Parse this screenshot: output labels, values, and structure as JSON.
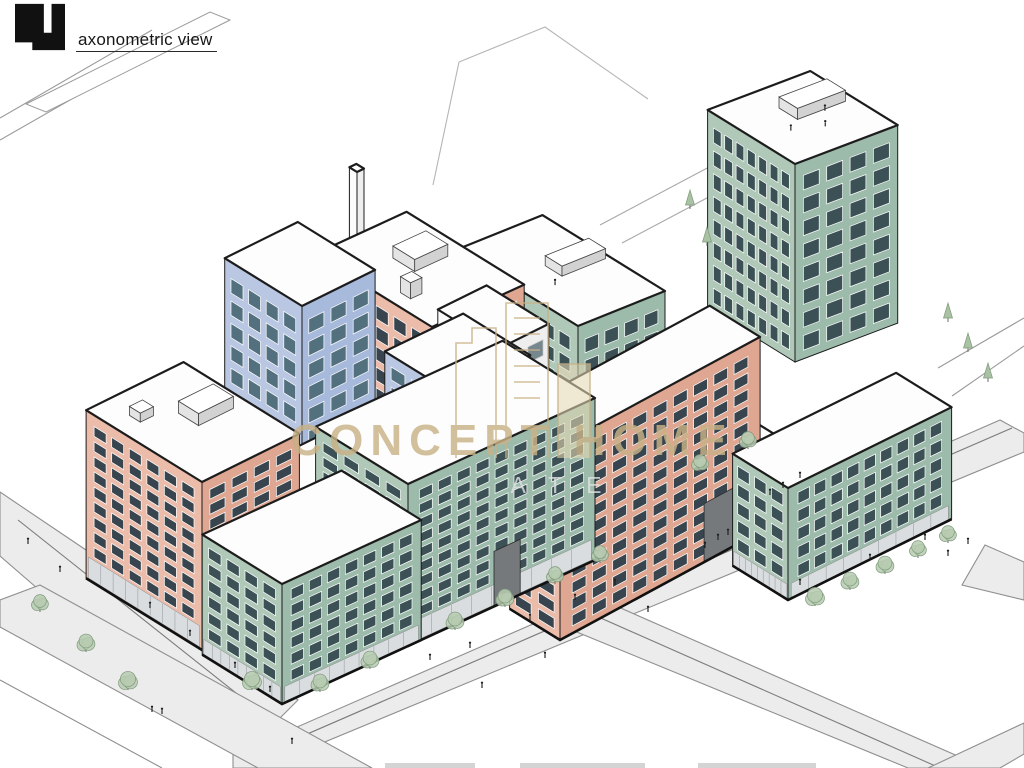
{
  "header": {
    "title": "axonometric view",
    "logo": "blocky-numeral-4-logo"
  },
  "watermark": {
    "title": "CONCEPT HOME",
    "visible_fragment": "ATE",
    "icon": "towers-outline-icon",
    "color": "#c9b287"
  },
  "footer": {
    "cropped_fragments": 3
  },
  "palette": {
    "salmon": {
      "sw": "#ecbcab",
      "se": "#dfa691",
      "glass": "#39454e",
      "frame": "#ffffff"
    },
    "green": {
      "sw": "#afc8b8",
      "se": "#9dbbab",
      "glass": "#3c5156",
      "frame": "#ffffff"
    },
    "blue": {
      "sw": "#b9c7e3",
      "se": "#a8badb",
      "glass": "#53707f",
      "frame": "#ffffff"
    },
    "white": {
      "sw": "#fbfbfb",
      "se": "#eeeeee",
      "glass": "#76878e",
      "frame": "#c9c9c9"
    },
    "roof": "#fdfdfd",
    "outline": "#1c1c1c",
    "road_fill": "#ececec",
    "road_edge": "#8f8f8f",
    "store": "#d9dde0",
    "arch": "#75797c",
    "tree_fill": "#b7cbb2",
    "tree_stroke": "#7e9a7a",
    "person": "#1f1f1f"
  },
  "scene": {
    "buildings": [
      {
        "name": "chimney",
        "color": "white",
        "f": [
          357,
          290
        ],
        "wR": 8,
        "wL": 9,
        "h": 118,
        "floors": 0,
        "colsSE": 0,
        "colsSW": 0
      },
      {
        "name": "tower-north-east",
        "color": "green",
        "f": [
          795,
          362
        ],
        "wR": 118,
        "wL": 104,
        "h": 198,
        "floors": 8,
        "colsSE": 4,
        "colsSW": 7,
        "ux": 0.87,
        "uy": -0.33,
        "roofBoxes": [
          {
            "fu": 0.45,
            "fv": 0.5,
            "su": 55,
            "sl": 22,
            "h": 11
          }
        ],
        "roofPeople": 3
      },
      {
        "name": "tower-north",
        "color": "green",
        "f": [
          578,
          558
        ],
        "wR": 100,
        "wL": 146,
        "h": 232,
        "floors": 10,
        "colsSE": 4,
        "colsSW": 7,
        "ux": 0.87,
        "uy": -0.35,
        "roofBoxes": [
          {
            "fu": 0.45,
            "fv": 0.45,
            "su": 50,
            "sl": 20,
            "h": 10
          }
        ],
        "roofPeople": 1
      },
      {
        "name": "midrise-back-salmon",
        "color": "salmon",
        "f": [
          432,
          505
        ],
        "wR": 106,
        "wL": 140,
        "h": 178,
        "floors": 8,
        "colsSE": 4,
        "colsSW": 6,
        "ux": 0.87,
        "uy": -0.4,
        "roofBoxes": [
          {
            "fu": 0.45,
            "fv": 0.5,
            "su": 38,
            "sl": 26,
            "h": 12
          },
          {
            "fu": 0.15,
            "fv": 0.3,
            "su": 13,
            "sl": 12,
            "h": 16
          }
        ]
      },
      {
        "name": "tower-back-blue",
        "color": "blue",
        "f": [
          302,
          548
        ],
        "wR": 84,
        "wL": 92,
        "h": 242,
        "floors": 10,
        "colsSE": 3,
        "colsSW": 4
      },
      {
        "name": "courtyard-building-white",
        "color": "white",
        "f": [
          500,
          508
        ],
        "wR": 56,
        "wL": 74,
        "h": 160,
        "floors": 6,
        "colsSE": 2,
        "colsSW": 3
      },
      {
        "name": "courtyard-roof-east",
        "color": "white",
        "f": [
          705,
          512
        ],
        "wR": 100,
        "wL": 118,
        "h": 24,
        "floors": 0,
        "roofPeople": 5
      },
      {
        "name": "block-center-salmon",
        "color": "salmon",
        "f": [
          560,
          640
        ],
        "wR": 230,
        "wL": 60,
        "h": 195,
        "floors": 11,
        "colsSE": 9,
        "colsSW": 2,
        "ux": 0.87,
        "uy": -0.47,
        "base": true,
        "arch": {
          "face": "SE",
          "u0": 0.72,
          "u1": 0.88,
          "v0": 0.7
        }
      },
      {
        "name": "podium-east-green",
        "color": "green",
        "f": [
          788,
          600
        ],
        "wR": 188,
        "wL": 66,
        "h": 112,
        "floors": 5,
        "colsSE": 9,
        "colsSW": 3,
        "store": true,
        "base": true
      },
      {
        "name": "courtyard-roof-west",
        "color": "white",
        "f": [
          352,
          596
        ],
        "wR": 140,
        "wL": 150,
        "h": 36,
        "floors": 0,
        "roofPeople": 6
      },
      {
        "name": "tower-west-salmon",
        "color": "salmon",
        "f": [
          202,
          650
        ],
        "wR": 112,
        "wL": 138,
        "h": 168,
        "floors": 9,
        "colsSE": 4,
        "colsSW": 6,
        "store": true,
        "base": true,
        "roofBoxes": [
          {
            "fu": 0.5,
            "fv": 0.45,
            "su": 40,
            "sl": 24,
            "h": 12
          },
          {
            "fu": 0.2,
            "fv": 0.7,
            "su": 15,
            "sl": 13,
            "h": 9
          }
        ]
      },
      {
        "name": "tower-front-blue",
        "color": "blue",
        "f": [
          452,
          545
        ],
        "wR": 90,
        "wL": 80,
        "h": 152,
        "floors": 7,
        "colsSE": 4,
        "colsSW": 3,
        "ux": 0.87,
        "uy": -0.42
      },
      {
        "name": "podium-front-green",
        "color": "green",
        "f": [
          408,
          646
        ],
        "wR": 215,
        "wL": 110,
        "h": 162,
        "floors": 9,
        "colsSE": 9,
        "colsSW": 4,
        "ux": 0.87,
        "uy": -0.4,
        "store": true,
        "base": true,
        "arch": {
          "face": "SE",
          "u0": 0.46,
          "u1": 0.6,
          "v0": 0.66
        }
      },
      {
        "name": "corner-front-green",
        "color": "green",
        "f": [
          282,
          704
        ],
        "wR": 160,
        "wL": 95,
        "h": 120,
        "floors": 6,
        "colsSE": 7,
        "colsSW": 4,
        "ux": 0.87,
        "uy": -0.4,
        "store": true,
        "base": true
      }
    ],
    "trees": {
      "leafy": [
        [
          40,
          612,
          7
        ],
        [
          86,
          652,
          8
        ],
        [
          128,
          690,
          9
        ],
        [
          252,
          690,
          9
        ],
        [
          320,
          692,
          8
        ],
        [
          370,
          669,
          8
        ],
        [
          455,
          630,
          8
        ],
        [
          505,
          607,
          8
        ],
        [
          555,
          584,
          7
        ],
        [
          600,
          563,
          7
        ],
        [
          815,
          606,
          9
        ],
        [
          850,
          590,
          8
        ],
        [
          885,
          574,
          8
        ],
        [
          918,
          558,
          7
        ],
        [
          948,
          543,
          7
        ],
        [
          700,
          472,
          7
        ],
        [
          748,
          449,
          7
        ]
      ],
      "pine": [
        [
          690,
          205
        ],
        [
          707,
          242
        ],
        [
          948,
          318
        ],
        [
          968,
          348
        ],
        [
          988,
          378
        ]
      ]
    },
    "people": [
      [
        150,
        608
      ],
      [
        190,
        636
      ],
      [
        235,
        668
      ],
      [
        270,
        692
      ],
      [
        152,
        712
      ],
      [
        162,
        714
      ],
      [
        60,
        572
      ],
      [
        28,
        544
      ],
      [
        430,
        660
      ],
      [
        470,
        648
      ],
      [
        482,
        688
      ],
      [
        530,
        620
      ],
      [
        575,
        600
      ],
      [
        615,
        585
      ],
      [
        705,
        548
      ],
      [
        800,
        585
      ],
      [
        870,
        560
      ],
      [
        925,
        540
      ],
      [
        718,
        540
      ],
      [
        728,
        535
      ],
      [
        770,
        495
      ],
      [
        783,
        488
      ],
      [
        800,
        478
      ],
      [
        545,
        658
      ],
      [
        648,
        612
      ],
      [
        292,
        744
      ],
      [
        948,
        556
      ],
      [
        968,
        544
      ]
    ],
    "roof_people_fracs": [
      [
        0.3,
        0.4
      ],
      [
        0.55,
        0.3
      ],
      [
        0.7,
        0.48
      ],
      [
        0.4,
        0.62
      ],
      [
        0.62,
        0.6
      ],
      [
        0.25,
        0.55
      ]
    ]
  }
}
